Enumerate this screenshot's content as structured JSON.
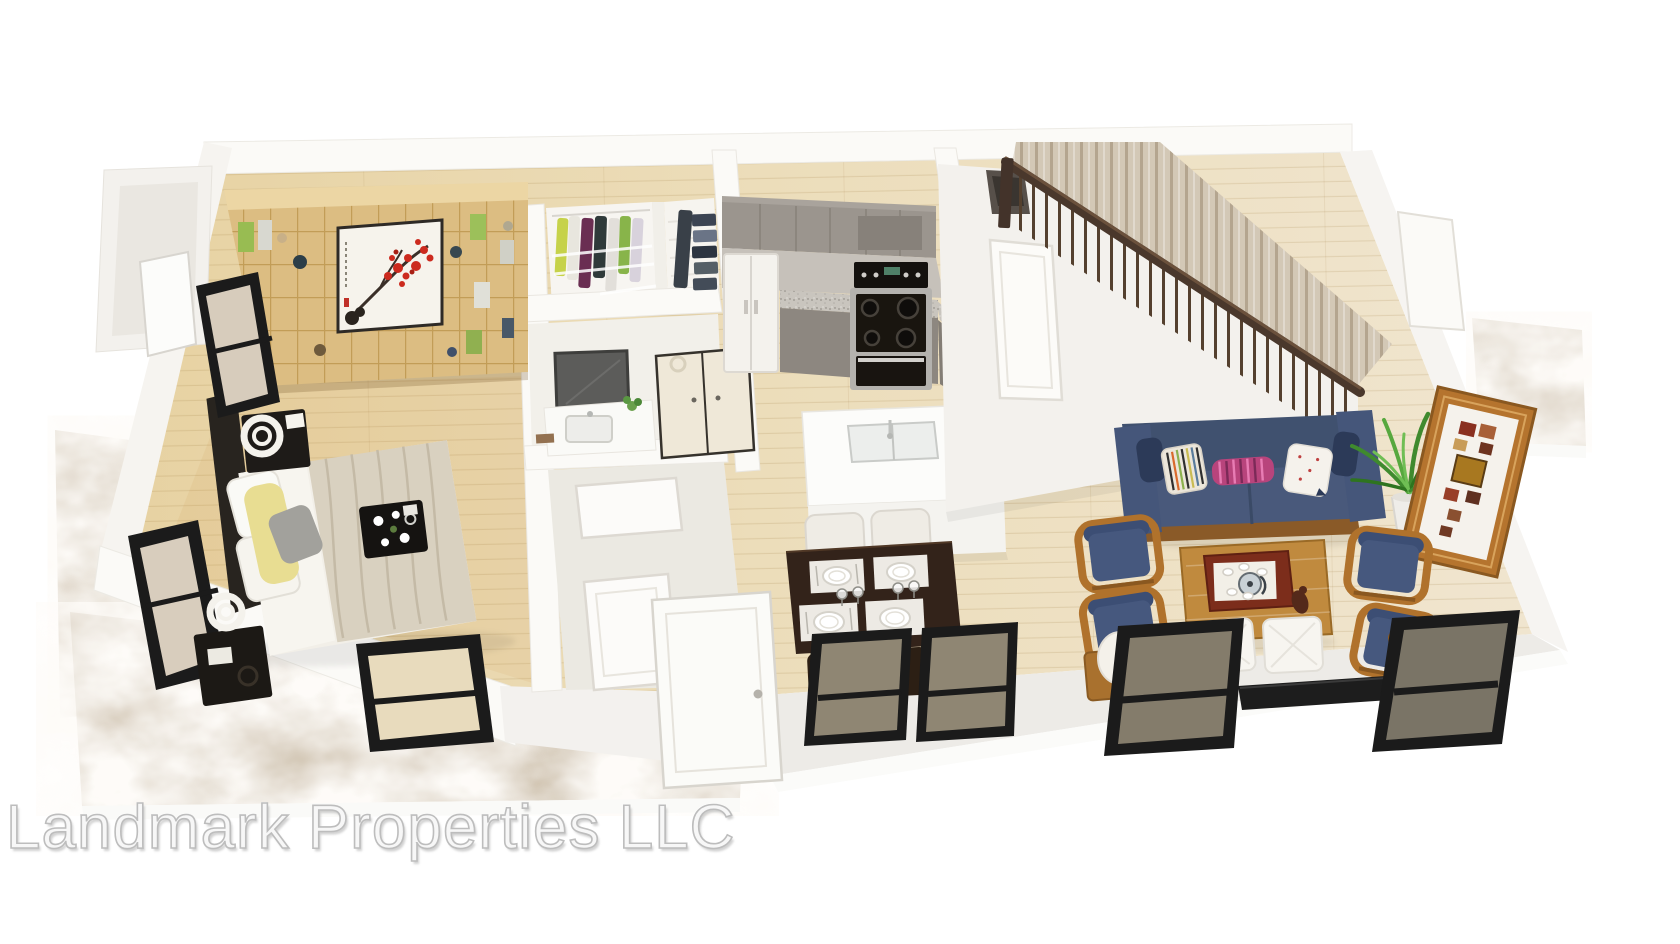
{
  "watermark": {
    "text": "Landmark Properties LLC"
  },
  "scene": {
    "type": "3d-floorplan-rendering",
    "rooms": [
      {
        "name": "bedroom",
        "items": [
          "bookshelf-wall-unit",
          "plum-blossom-artwork",
          "double-bed",
          "yellow-pillow",
          "gray-pillow",
          "breakfast-tray",
          "nightstand",
          "ring-table-lamp",
          "black-framed-windows"
        ]
      },
      {
        "name": "walk-in-closet",
        "items": [
          "hanging-clothes",
          "wire-shelving"
        ]
      },
      {
        "name": "linen-closet",
        "items": [
          "folded-linens",
          "wire-shelves"
        ]
      },
      {
        "name": "bathroom",
        "items": [
          "vanity-mirror",
          "vanity-sink",
          "small-plant"
        ]
      },
      {
        "name": "laundry-closet",
        "items": [
          "cream-double-doors"
        ]
      },
      {
        "name": "kitchen",
        "items": [
          "gray-upper-cabinets",
          "range-hood",
          "granite-countertop",
          "range-oven",
          "refrigerator",
          "gray-lower-cabinets"
        ]
      },
      {
        "name": "island",
        "items": [
          "white-waterfall-island",
          "undermount-sink",
          "faucet"
        ]
      },
      {
        "name": "dining-area",
        "items": [
          "espresso-dining-table",
          "white-upholstered-chairs",
          "place-settings",
          "wine-glasses",
          "dark-dining-chairs"
        ]
      },
      {
        "name": "living-room",
        "items": [
          "navy-sofa",
          "striped-throw-pillows",
          "wood-coffee-table",
          "red-serving-tray",
          "tea-set",
          "wood-armchairs-with-blue-cushions",
          "white-ottomans",
          "potted-plant",
          "leaning-photo-collage-frame",
          "white-table-lamps",
          "black-media-console"
        ]
      },
      {
        "name": "staircase",
        "items": [
          "dark-handrail",
          "metal-balusters",
          "carpeted-treads",
          "under-stair-closet-door"
        ]
      },
      {
        "name": "exterior",
        "items": [
          "marble-patio",
          "marble-side-walk",
          "marble-side-stoop",
          "white-front-door",
          "black-framed-front-windows",
          "side-door"
        ]
      }
    ]
  },
  "palette": {
    "wall_white": "#fbfaf7",
    "wall_shade": "#ebe9e3",
    "floor_wood_dark": "#e7d2a2",
    "floor_wood_light": "#f0e5cf",
    "marble": "#cfc2ae",
    "sofa_blue": "#49597b",
    "cushion_blue": "#46587e",
    "chair_wood": "#b0722c",
    "coffee_wood": "#c08a3e",
    "dining_table": "#33231a",
    "cabinet_gray": "#9b958e",
    "cabinet_gray_dark": "#8d8780",
    "granite_gray": "#c9c5be",
    "bookshelf_tan": "#dcbd82",
    "blossom_red": "#cc2a1e",
    "pillow_yellow": "#e8dd92",
    "pillow_pink": "#b8447c",
    "stair_rail": "#4a382c",
    "stair_tread": "#d3c8b6",
    "window_frame": "#1b1b1b",
    "watermark_gray": "#bdbdbd"
  }
}
